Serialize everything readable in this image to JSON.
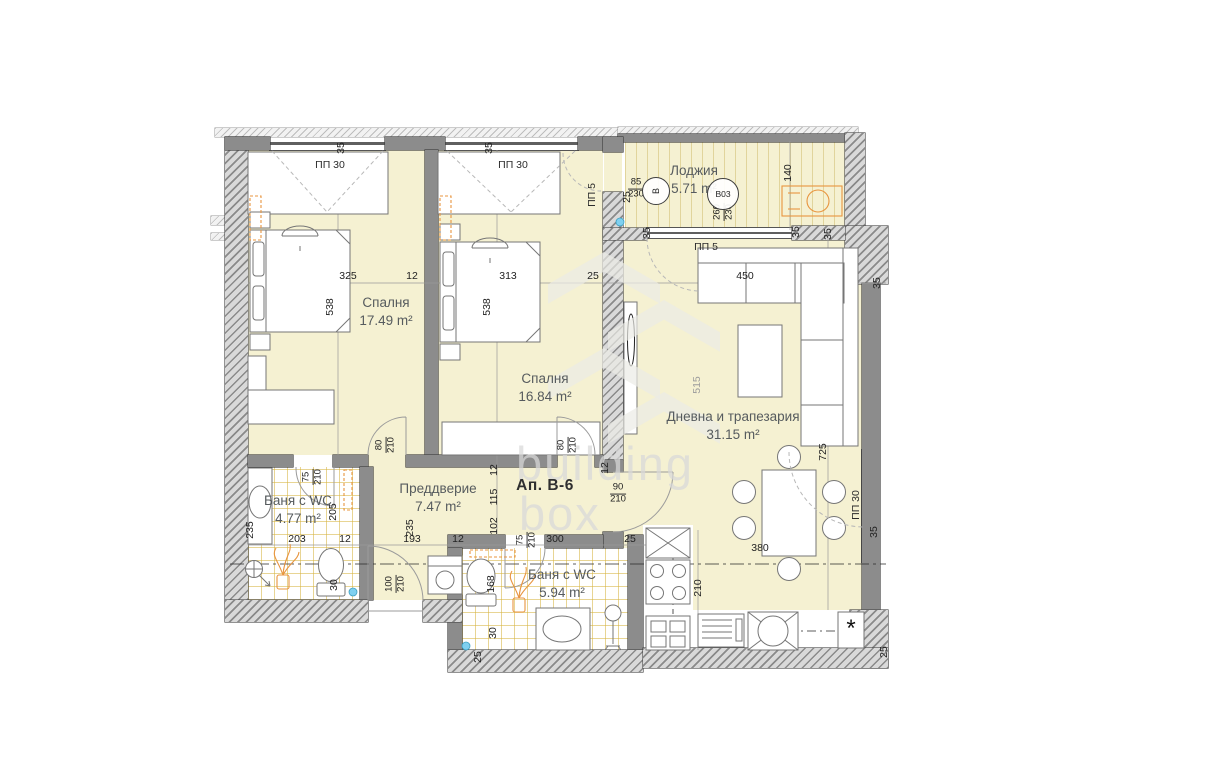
{
  "unit_label": "Ап. В-6",
  "watermark": {
    "line1": "building",
    "line2": "box"
  },
  "asterisk": "*",
  "rooms": [
    {
      "name": "Спалня",
      "area": "17.49 m²",
      "x": 386,
      "y": 294
    },
    {
      "name": "Спалня",
      "area": "16.84 m²",
      "x": 545,
      "y": 370
    },
    {
      "name": "Лоджия",
      "area": "5.71 m²",
      "x": 694,
      "y": 162
    },
    {
      "name": "Дневна и трапезария",
      "area": "31.15 m²",
      "x": 733,
      "y": 408
    },
    {
      "name": "Баня с WC",
      "area": "4.77 m²",
      "x": 298,
      "y": 492
    },
    {
      "name": "Преддверие",
      "area": "7.47 m²",
      "x": 438,
      "y": 480
    },
    {
      "name": "Баня с WC",
      "area": "5.94 m²",
      "x": 562,
      "y": 566
    }
  ],
  "door_window_labels": [
    {
      "t": "ПП 30",
      "x": 330,
      "y": 165,
      "r": 0
    },
    {
      "t": "ПП 30",
      "x": 513,
      "y": 165,
      "r": 0
    },
    {
      "t": "ПП 5",
      "x": 592,
      "y": 195,
      "r": -90
    },
    {
      "t": "ПП 5",
      "x": 706,
      "y": 247,
      "r": 0
    },
    {
      "t": "ПП 30",
      "x": 856,
      "y": 505,
      "r": -90
    }
  ],
  "dims": [
    {
      "t": "325",
      "x": 348,
      "y": 276
    },
    {
      "t": "12",
      "x": 412,
      "y": 276
    },
    {
      "t": "313",
      "x": 508,
      "y": 276
    },
    {
      "t": "25",
      "x": 593,
      "y": 276
    },
    {
      "t": "450",
      "x": 745,
      "y": 276
    },
    {
      "t": "538",
      "x": 330,
      "y": 307,
      "r": -90
    },
    {
      "t": "538",
      "x": 487,
      "y": 307,
      "r": -90
    },
    {
      "t": "35",
      "x": 341,
      "y": 148,
      "r": -90
    },
    {
      "t": "35",
      "x": 489,
      "y": 148,
      "r": -90
    },
    {
      "t": "25",
      "x": 627,
      "y": 197,
      "r": -90
    },
    {
      "t": "140",
      "x": 788,
      "y": 173,
      "r": -90
    },
    {
      "t": "35",
      "x": 647,
      "y": 233,
      "r": -90
    },
    {
      "t": "35",
      "x": 796,
      "y": 232,
      "r": -90
    },
    {
      "t": "35",
      "x": 828,
      "y": 234,
      "r": -90
    },
    {
      "t": "35",
      "x": 877,
      "y": 283,
      "r": -90
    },
    {
      "t": "515",
      "x": 697,
      "y": 385,
      "r": -90,
      "c": "faint"
    },
    {
      "t": "725",
      "x": 823,
      "y": 452,
      "r": -90
    },
    {
      "t": "203",
      "x": 297,
      "y": 539
    },
    {
      "t": "12",
      "x": 345,
      "y": 539
    },
    {
      "t": "193",
      "x": 412,
      "y": 539
    },
    {
      "t": "12",
      "x": 458,
      "y": 539
    },
    {
      "t": "300",
      "x": 555,
      "y": 539
    },
    {
      "t": "25",
      "x": 630,
      "y": 539
    },
    {
      "t": "235",
      "x": 250,
      "y": 530,
      "r": -90
    },
    {
      "t": "205",
      "x": 333,
      "y": 512,
      "r": -90
    },
    {
      "t": "30",
      "x": 334,
      "y": 585,
      "r": -90
    },
    {
      "t": "235",
      "x": 410,
      "y": 528,
      "r": -90
    },
    {
      "t": "12",
      "x": 494,
      "y": 470,
      "r": -90
    },
    {
      "t": "115",
      "x": 494,
      "y": 497,
      "r": -90
    },
    {
      "t": "102",
      "x": 494,
      "y": 526,
      "r": -90
    },
    {
      "t": "12",
      "x": 605,
      "y": 468,
      "r": -90
    },
    {
      "t": "168",
      "x": 491,
      "y": 584,
      "r": -90
    },
    {
      "t": "30",
      "x": 493,
      "y": 633,
      "r": -90
    },
    {
      "t": "25",
      "x": 478,
      "y": 657,
      "r": -90
    },
    {
      "t": "210",
      "x": 698,
      "y": 588,
      "r": -90
    },
    {
      "t": "380",
      "x": 760,
      "y": 548
    },
    {
      "t": "35",
      "x": 874,
      "y": 532,
      "r": -90
    },
    {
      "t": "25",
      "x": 884,
      "y": 652,
      "r": -90
    }
  ],
  "fracs": [
    {
      "a": "75",
      "b": "210",
      "x": 313,
      "y": 477,
      "r": -90
    },
    {
      "a": "80",
      "b": "210",
      "x": 386,
      "y": 445,
      "r": -90
    },
    {
      "a": "80",
      "b": "210",
      "x": 568,
      "y": 445,
      "r": -90
    },
    {
      "a": "90",
      "b": "210",
      "x": 618,
      "y": 494,
      "r": 0
    },
    {
      "a": "100",
      "b": "210",
      "x": 396,
      "y": 584,
      "r": -90
    },
    {
      "a": "75",
      "b": "210",
      "x": 527,
      "y": 540,
      "r": -90
    },
    {
      "a": "85",
      "b": "230",
      "x": 636,
      "y": 189,
      "r": 0
    },
    {
      "a": "260",
      "b": "230",
      "x": 724,
      "y": 212,
      "r": -90
    }
  ],
  "circles": [
    {
      "t": "В",
      "x": 655,
      "y": 190,
      "d": 26,
      "r": -90,
      "fs": 9
    },
    {
      "t": "В03",
      "x": 722,
      "y": 193,
      "d": 30,
      "r": 0,
      "fs": 8.5
    }
  ]
}
